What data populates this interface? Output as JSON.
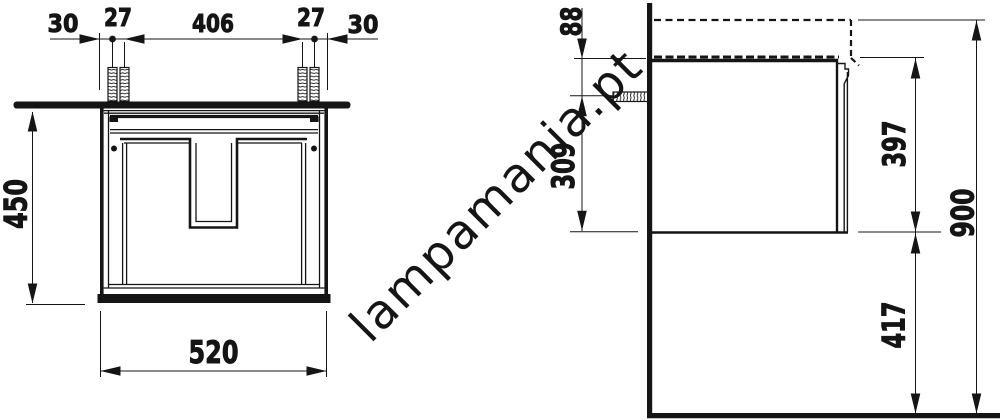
{
  "drawing": {
    "type": "vanity-unit installation drawing, front and side view",
    "line_color": "#151515",
    "background": "#ffffff",
    "watermark": {
      "text": "lampamania.pt",
      "color": "#cccccc"
    },
    "front_view": {
      "dims": {
        "left_edge_to_hole": "30",
        "left_hole_gap": "27",
        "hole_span": "406",
        "right_hole_gap": "27",
        "right_edge_to_hole": "30",
        "cabinet_height": "450",
        "cabinet_width": "520"
      }
    },
    "side_view": {
      "dims": {
        "top_to_screw": "88",
        "screw_to_bottom": "309",
        "body_height": "397",
        "total_height": "900",
        "floor_clearance": "417"
      }
    }
  }
}
